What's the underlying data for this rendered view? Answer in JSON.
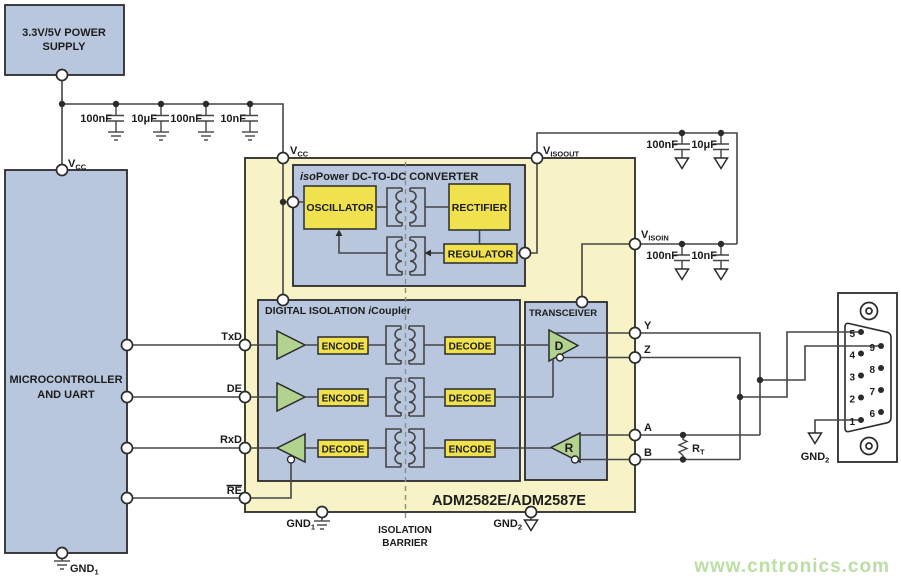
{
  "power_supply": {
    "line1": "3.3V/5V POWER",
    "line2": "SUPPLY"
  },
  "mcu": {
    "line1": "MICROCONTROLLER",
    "line2": "AND UART"
  },
  "rail_caps": {
    "c1": "100nF",
    "c2": "10μF",
    "c3": "100nF",
    "c4": "10nF"
  },
  "iso_caps_top": {
    "c1": "100nF",
    "c2": "10μF"
  },
  "iso_caps_mid": {
    "c1": "100nF",
    "c2": "10nF"
  },
  "labels": {
    "vcc_left": {
      "base": "V",
      "sub": "CC"
    },
    "vcc_chip": {
      "base": "V",
      "sub": "CC"
    },
    "visoout": {
      "base": "V",
      "sub": "ISOOUT"
    },
    "visoin": {
      "base": "V",
      "sub": "ISOIN"
    },
    "gnd1_left": {
      "base": "GND",
      "sub": "1"
    },
    "gnd1_chip": {
      "base": "GND",
      "sub": "1"
    },
    "gnd2_chip": {
      "base": "GND",
      "sub": "2"
    },
    "gnd2_conn": {
      "base": "GND",
      "sub": "2"
    },
    "txd": "TxD",
    "de": "DE",
    "rxd": "RxD",
    "re": "RE",
    "y": "Y",
    "z": "Z",
    "a": "A",
    "b": "B",
    "rt": {
      "base": "R",
      "sub": "T"
    }
  },
  "chip": {
    "part": "ADM2582E/ADM2587E"
  },
  "dcdc": {
    "title_prefix": "iso",
    "title_rest": "Power DC-TO-DC CONVERTER",
    "oscillator": "OSCILLATOR",
    "rectifier": "RECTIFIER",
    "regulator": "REGULATOR"
  },
  "digital_isolation": {
    "title_prefix": "DIGITAL ISOLATION ",
    "title_i": "i",
    "title_rest": "Coupler",
    "row1_left": "ENCODE",
    "row1_right": "DECODE",
    "row2_left": "ENCODE",
    "row2_right": "DECODE",
    "row3_left": "DECODE",
    "row3_right": "ENCODE"
  },
  "transceiver": {
    "title": "TRANSCEIVER",
    "driver": "D",
    "receiver": "R"
  },
  "isolation_barrier": {
    "line1": "ISOLATION",
    "line2": "BARRIER"
  },
  "connector": {
    "pin1": "1",
    "pin2": "2",
    "pin3": "3",
    "pin4": "4",
    "pin5": "5",
    "pin6": "6",
    "pin7": "7",
    "pin8": "8",
    "pin9": "9"
  },
  "watermark": {
    "text": "www.cntronics.com"
  },
  "colors": {
    "block_blue": "#b9c7de",
    "chip_body_yellow": "#f7f3c7",
    "function_block_yellow": "#f0e14e",
    "buffer_green": "#b2d38f",
    "wire": "#454545",
    "watermark_green": "#bcdda4"
  }
}
